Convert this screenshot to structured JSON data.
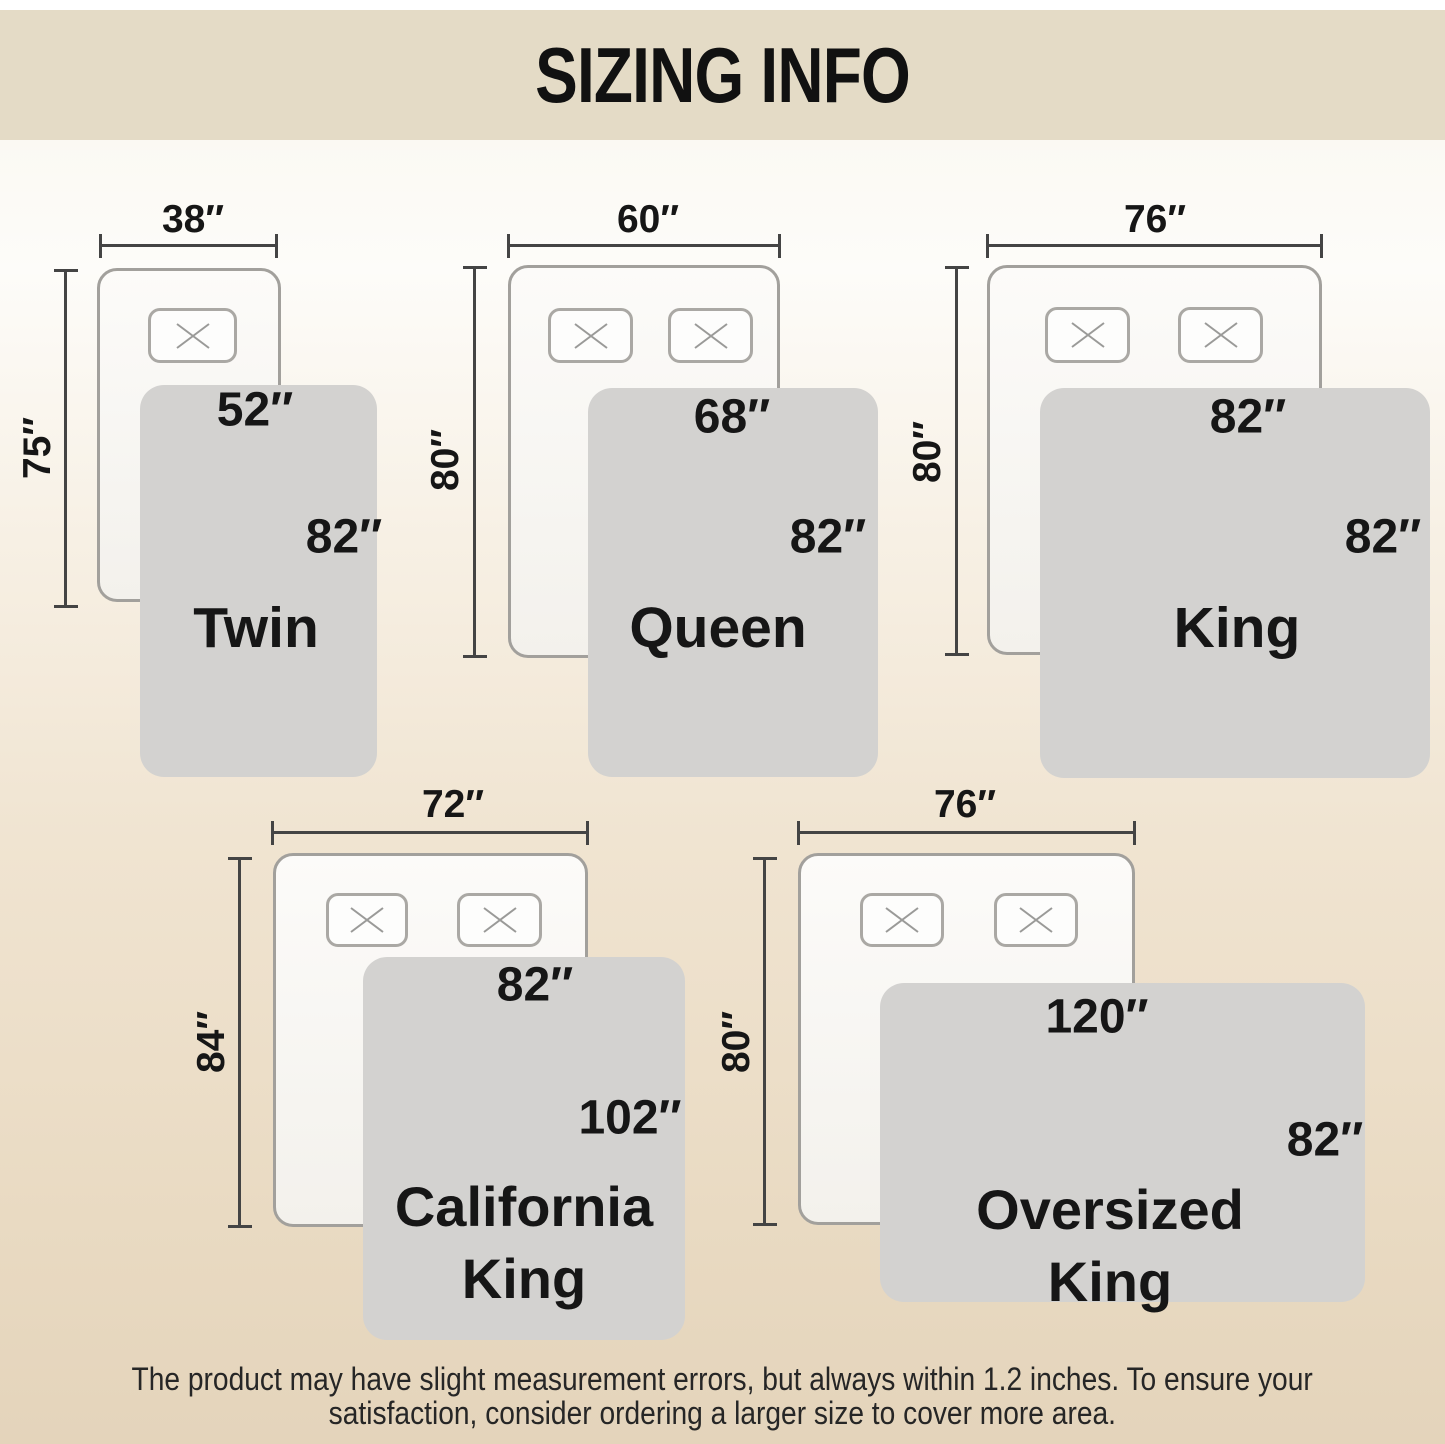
{
  "header": {
    "title": "SIZING INFO"
  },
  "sizes": [
    {
      "name": "Twin",
      "bed_width": "38″",
      "bed_length": "75″",
      "blanket_width": "52″",
      "blanket_length": "82″"
    },
    {
      "name": "Queen",
      "bed_width": "60″",
      "bed_length": "80″",
      "blanket_width": "68″",
      "blanket_length": "82″"
    },
    {
      "name": "King",
      "bed_width": "76″",
      "bed_length": "80″",
      "blanket_width": "82″",
      "blanket_length": "82″"
    },
    {
      "name": "California King",
      "bed_width": "72″",
      "bed_length": "84″",
      "blanket_width": "82″",
      "blanket_length": "102″"
    },
    {
      "name": "Oversized King",
      "bed_width": "76″",
      "bed_length": "80″",
      "blanket_width": "120″",
      "blanket_length": "82″"
    }
  ],
  "footer": {
    "line1": "The product may have slight measurement errors, but always within 1.2 inches. To ensure your",
    "line2": "satisfaction, consider ordering a larger size to cover more area."
  },
  "colors": {
    "header_band": "#e4dbc6",
    "background_top": "#fbf9f3",
    "background_bottom": "#e4d4bb",
    "blanket_gray": "#d3d2d0",
    "mattress_fill": "#f8f6f2",
    "mattress_border": "#a2a09c",
    "dimension_line": "#444444",
    "text": "#161616"
  }
}
